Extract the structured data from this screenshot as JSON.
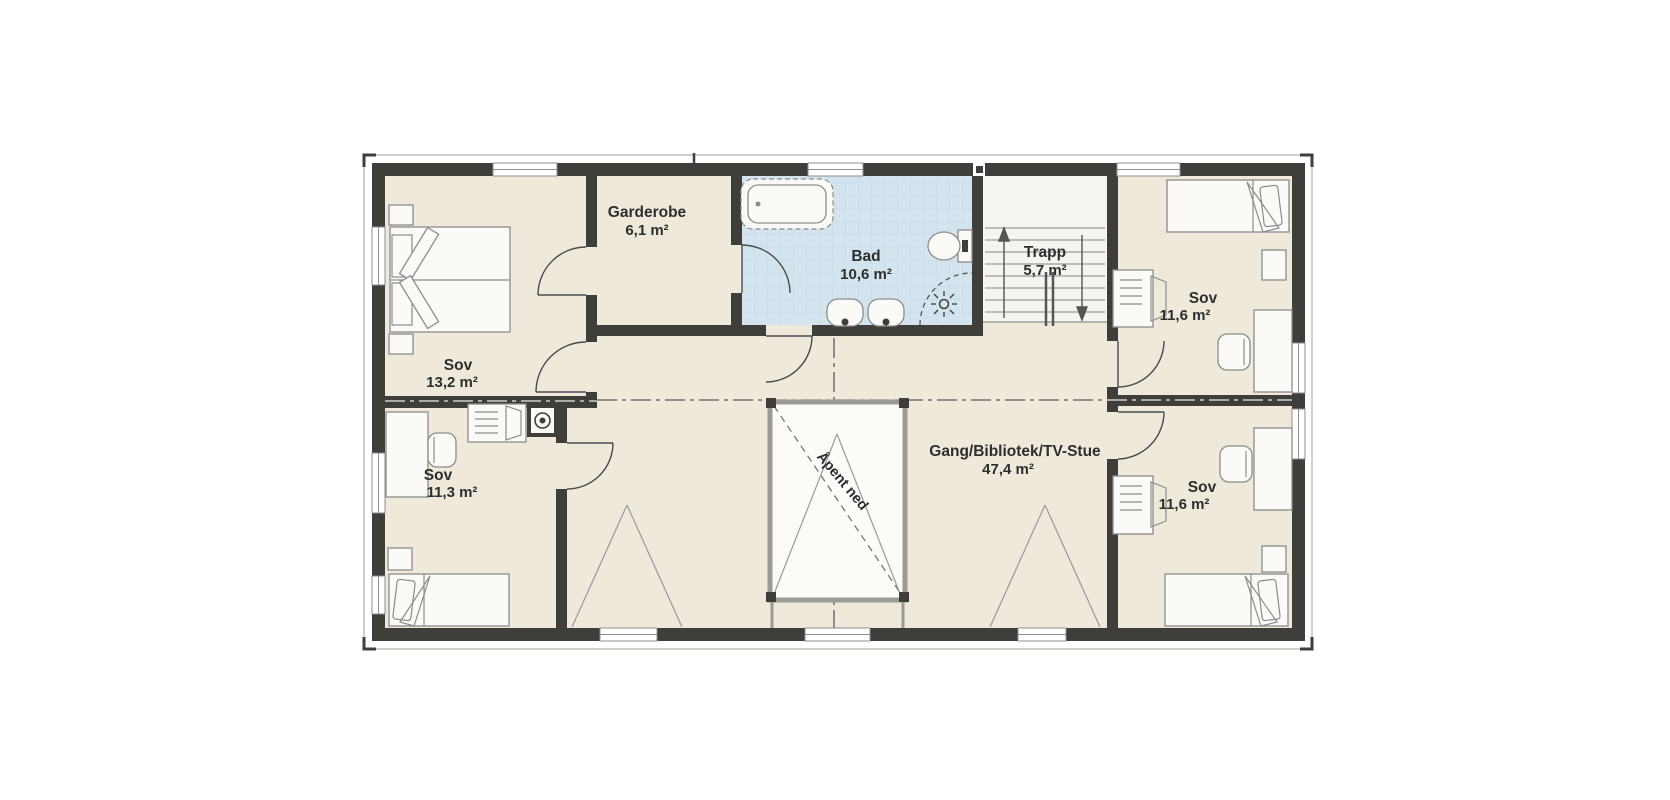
{
  "plan": {
    "rooms": {
      "sov_master": {
        "name": "Sov",
        "area": "13,2 m²"
      },
      "garderobe": {
        "name": "Garderobe",
        "area": "6,1 m²"
      },
      "bad": {
        "name": "Bad",
        "area": "10,6 m²"
      },
      "trapp": {
        "name": "Trapp",
        "area": "5,7 m²"
      },
      "sov_top_right": {
        "name": "Sov",
        "area": "11,6 m²"
      },
      "sov_bottom_left": {
        "name": "Sov",
        "area": "11,3 m²"
      },
      "sov_bottom_right": {
        "name": "Sov",
        "area": "11,6 m²"
      },
      "gang": {
        "name": "Gang/Bibliotek/TV-Stue",
        "area": "47,4 m²"
      }
    },
    "annotations": {
      "open_below": "Åpent ned"
    },
    "colors": {
      "wall": "#3f3e3b",
      "floor": "#efe9db",
      "bath": "#d3e4ef",
      "bath_grid": "#bfd6e4",
      "stair_floor": "#f6f4ee",
      "open_floor": "#fcfbf8",
      "furniture_stroke": "#8c8c8c",
      "line_gray": "#9a9a9a",
      "text": "#2e2e2e"
    }
  }
}
